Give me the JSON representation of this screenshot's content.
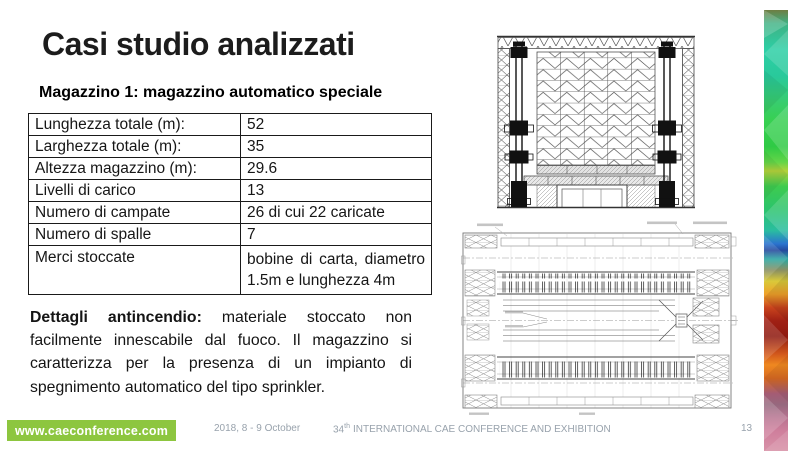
{
  "slide": {
    "title": "Casi studio analizzati",
    "subtitle": "Magazzino 1: magazzino automatico speciale"
  },
  "table": {
    "rows": [
      {
        "label": "Lunghezza totale (m):",
        "value": "52"
      },
      {
        "label": "Larghezza totale (m):",
        "value": "35"
      },
      {
        "label": "Altezza magazzino (m):",
        "value": "29.6"
      },
      {
        "label": "Livelli di carico",
        "value": "13"
      },
      {
        "label": "Numero di campate",
        "value": "26 di cui 22 caricate"
      },
      {
        "label": "Numero di spalle",
        "value": "7"
      },
      {
        "label": "Merci stoccate",
        "value": "bobine di carta, diametro 1.5m e lunghezza 4m"
      }
    ]
  },
  "fire_details": {
    "label": "Dettagli antincendio:",
    "text": " materiale stoccato non facilmente innescabile dal fuoco. Il magazzino si caratterizza per la presenza di un impianto di spegnimento automatico del tipo sprinkler."
  },
  "figures": {
    "elevation": "warehouse-front-elevation-technical-drawing",
    "plan": "warehouse-plan-view-technical-drawing"
  },
  "footer": {
    "website": "www.caeconference.com",
    "date": "2018, 8 - 9 October",
    "conference_number": "34",
    "conference_ordinal": "th",
    "conference_title": "INTERNATIONAL CAE CONFERENCE AND EXHIBITION",
    "page_number": "13"
  },
  "colors": {
    "banner_green": "#8dc63f",
    "footer_text_gray": "#98a2ac",
    "table_border": "#1a1a1a"
  }
}
